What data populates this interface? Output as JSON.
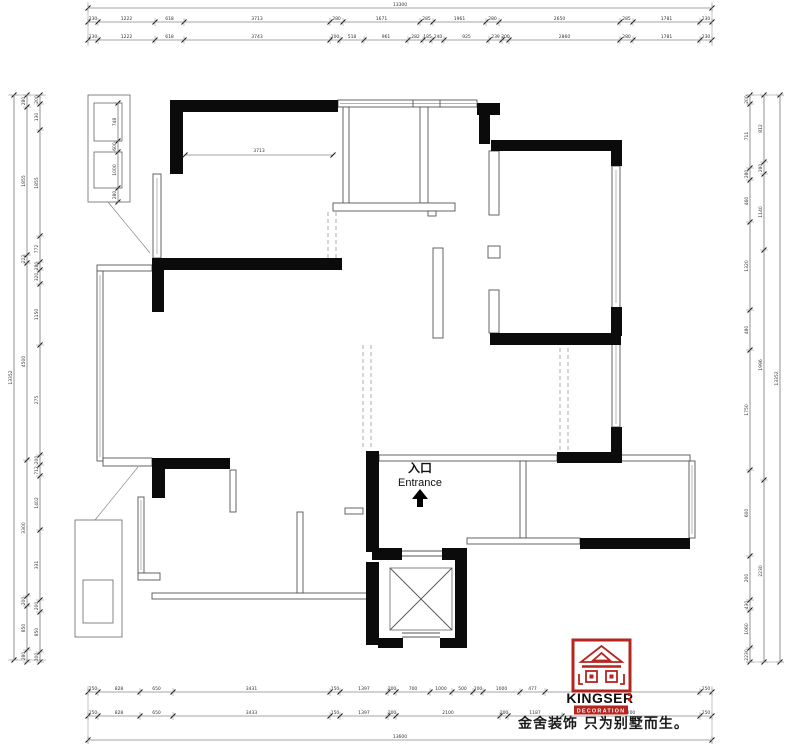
{
  "drawing": {
    "entrance": {
      "cn": "入口",
      "en": "Entrance"
    },
    "interior_dim_label": "3713",
    "colors": {
      "wall": "#0b0b0b",
      "thin_line": "#555555",
      "dimension": "#4a4a4a",
      "brand_red": "#b5241e"
    }
  },
  "dims": {
    "top_total": {
      "pos": 8,
      "ticks": [
        88,
        712
      ],
      "labels": [
        "13300"
      ]
    },
    "top_row1": {
      "pos": 22,
      "ticks": [
        88,
        98,
        155,
        184,
        330,
        343,
        420,
        433,
        486,
        499,
        620,
        633,
        700,
        712
      ],
      "labels": [
        "230",
        "1222",
        "618",
        "3713",
        "280",
        "1671",
        "285",
        "1961",
        "280",
        "2650",
        "285",
        "1781",
        "230"
      ]
    },
    "top_row2": {
      "pos": 40,
      "ticks": [
        88,
        98,
        155,
        184,
        330,
        340,
        364,
        408,
        423,
        432,
        444,
        489,
        502,
        509,
        620,
        633,
        700,
        712
      ],
      "labels": [
        "230",
        "1222",
        "618",
        "3743",
        "200",
        "518",
        "961",
        "282",
        "185",
        "240",
        "925",
        "239",
        "200",
        "2860",
        "280",
        "1781",
        "230"
      ]
    },
    "bottom_row1": {
      "pos": 692,
      "ticks": [
        88,
        98,
        140,
        173,
        330,
        340,
        388,
        396,
        430,
        452,
        473,
        483,
        520,
        545,
        700,
        712
      ],
      "labels": [
        "250",
        "828",
        "650",
        "3431",
        "150",
        "1397",
        "200",
        "700",
        "1000",
        "500",
        "200",
        "1000",
        "477",
        "700",
        "250"
      ]
    },
    "bottom_row2": {
      "pos": 716,
      "ticks": [
        88,
        98,
        140,
        173,
        330,
        340,
        388,
        396,
        500,
        508,
        562,
        700,
        712
      ],
      "labels": [
        "250",
        "828",
        "650",
        "3433",
        "150",
        "1397",
        "200",
        "2100",
        "200",
        "1187",
        "200",
        "250"
      ]
    },
    "bottom_total": {
      "pos": 740,
      "ticks": [
        88,
        712
      ],
      "labels": [
        "13600"
      ]
    },
    "left_total": {
      "pos": 14,
      "ticks": [
        95,
        660
      ],
      "labels": [
        "13352"
      ]
    },
    "left_outer": {
      "pos": 27,
      "ticks": [
        95,
        107,
        255,
        263,
        460,
        596,
        606,
        650,
        662
      ],
      "labels": [
        "280",
        "1855",
        "222",
        "4500",
        "3300",
        "200",
        "850",
        "280"
      ]
    },
    "left_inner": {
      "pos": 40,
      "ticks": [
        95,
        104,
        130,
        236,
        262,
        270,
        284,
        345,
        455,
        465,
        476,
        530,
        600,
        612,
        652,
        662
      ],
      "labels": [
        "200",
        "130",
        "1855",
        "772",
        "280",
        "320",
        "1150",
        "275",
        "200",
        "712",
        "1402",
        "331",
        "200",
        "850",
        "200"
      ]
    },
    "right_inner": {
      "pos": 750,
      "ticks": [
        95,
        104,
        168,
        180,
        222,
        310,
        350,
        470,
        556,
        600,
        610,
        648,
        662
      ],
      "labels": [
        "200",
        "711",
        "280",
        "460",
        "1320",
        "480",
        "1750",
        "600",
        "200",
        "430",
        "1060",
        "2230"
      ]
    },
    "right_outer": {
      "pos": 764,
      "ticks": [
        95,
        162,
        174,
        250,
        480,
        662
      ],
      "labels": [
        "812",
        "280",
        "1140",
        "1996",
        "2230"
      ]
    },
    "right_total": {
      "pos": 780,
      "ticks": [
        95,
        662
      ],
      "labels": [
        "13352"
      ]
    },
    "detail_box": {
      "pos": 118,
      "ticks": [
        103,
        141,
        152,
        188,
        202
      ],
      "labels": [
        "748",
        "600",
        "1000",
        "280"
      ]
    }
  },
  "logo": {
    "brand": "KINGSER",
    "sub": "DECORATION",
    "tagline": "金舍装饰 只为别墅而生。"
  }
}
